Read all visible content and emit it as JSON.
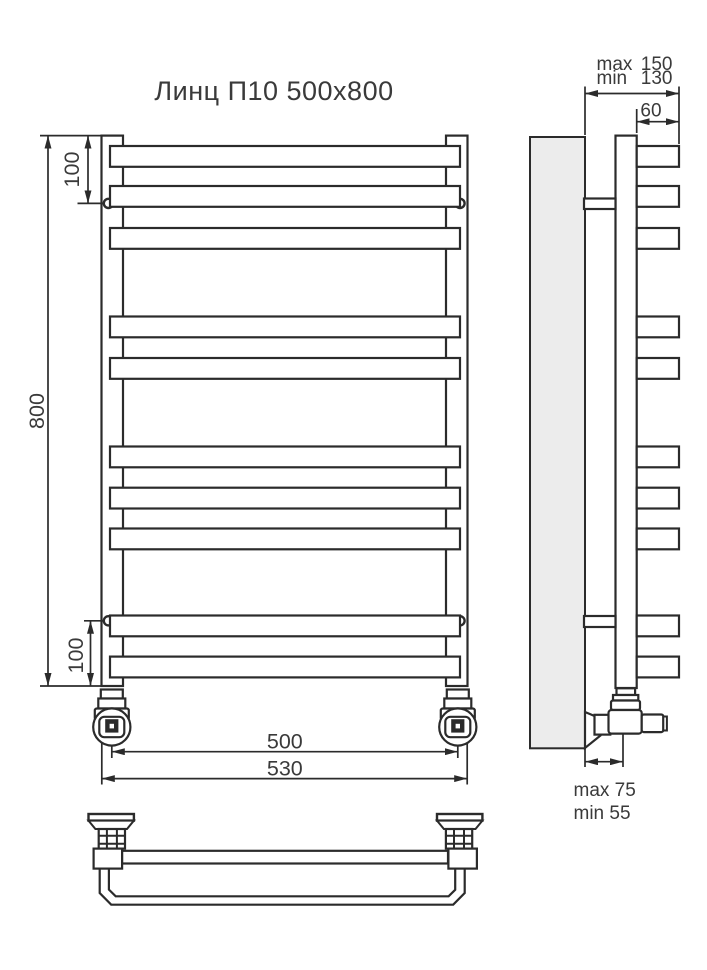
{
  "title": "Линц П10 500х800",
  "colors": {
    "line": "#2b2b2b",
    "text": "#3a3a3a",
    "wall_fill": "#ececec",
    "background": "#ffffff"
  },
  "front_view": {
    "bar_count": 10,
    "dim_height": "800",
    "dim_top_bracket_offset": "100",
    "dim_bottom_bracket_offset": "100",
    "dim_axle_distance": "500",
    "dim_overall_width": "530"
  },
  "side_view": {
    "wall_clearance": {
      "max_label": "max",
      "max_value": "150",
      "min_label": "min",
      "min_value": "130"
    },
    "dim_bar_depth": "60",
    "valve_offset": {
      "max": "max 75",
      "min": "min 55"
    }
  }
}
